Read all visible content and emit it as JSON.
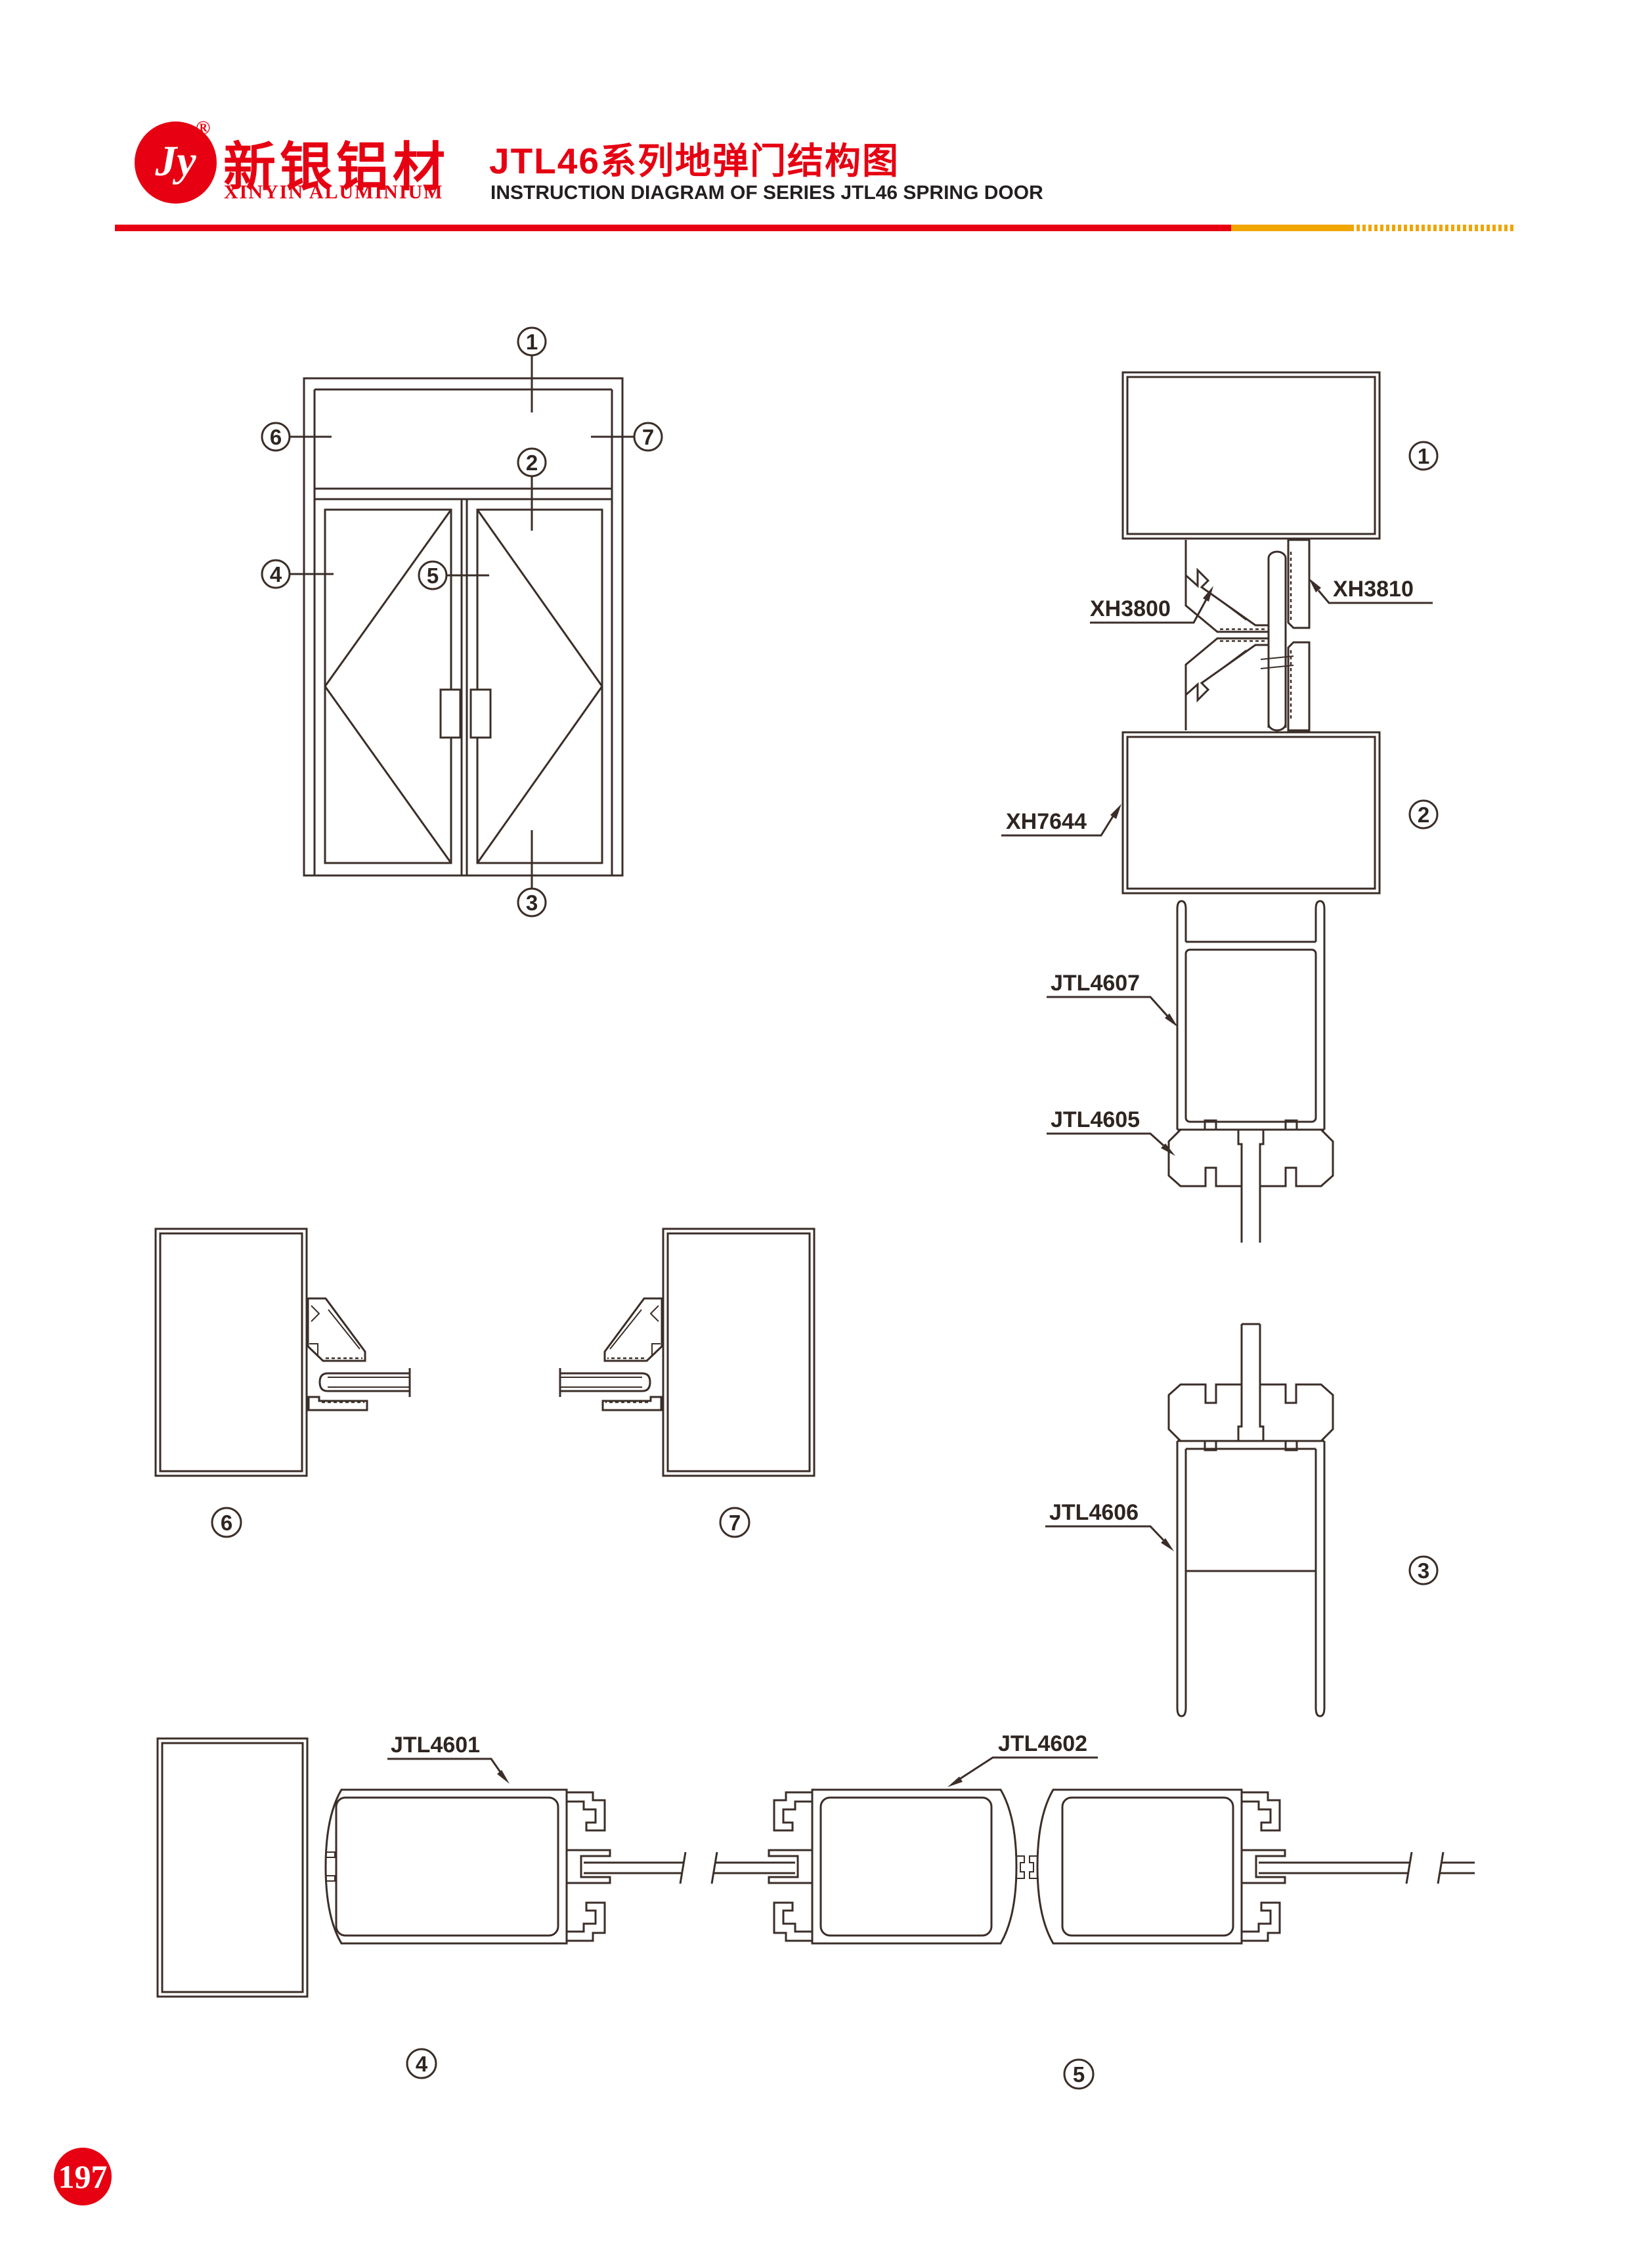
{
  "header": {
    "monogram": "Jy",
    "registered": "®",
    "brand_cn": "新银铝材",
    "brand_en": "XINYIN  ALUMINIUM",
    "title_cn": "JTL46系列地弹门结构图",
    "title_en": "INSTRUCTION DIAGRAM OF SERIES JTL46 SPRING DOOR"
  },
  "colors": {
    "brand_red": "#e60012",
    "accent_orange": "#f0a500",
    "line_art": "#3b2e28",
    "text_black": "#231f20"
  },
  "profile_labels": {
    "xh3800": "XH3800",
    "xh3810": "XH3810",
    "xh7644": "XH7644",
    "jtl4607": "JTL4607",
    "jtl4605": "JTL4605",
    "jtl4606": "JTL4606",
    "jtl4601": "JTL4601",
    "jtl4602": "JTL4602"
  },
  "callouts": {
    "n1": "1",
    "n2": "2",
    "n3": "3",
    "n4": "4",
    "n5": "5",
    "n6": "6",
    "n7": "7"
  },
  "page": {
    "number": "197"
  }
}
